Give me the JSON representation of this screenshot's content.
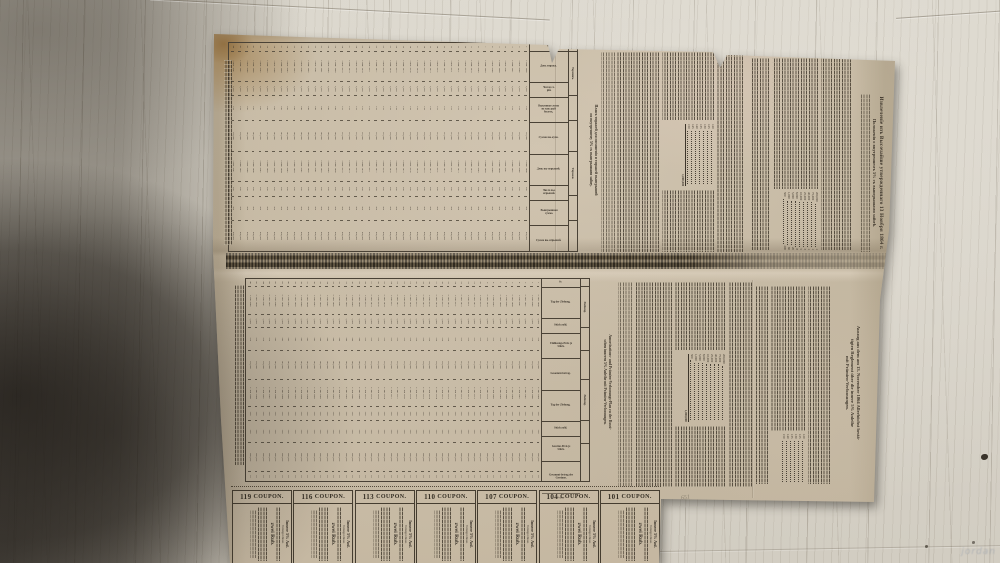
{
  "photo": {
    "watermark": "jordan",
    "pencil_note": "651"
  },
  "russian_section": {
    "heading_line1": "Извлеченіе изъ Высочайше утвержденнаго 13 Ноября 1864 г.",
    "heading_line2": "Положенія о внутреннемъ 5% съ выигрышами займѣ.",
    "table_title_line1": "Планъ тиражей для погашенія и тиражей выигрышей",
    "table_title_line2": "по внутреннему 5% съ выигрышами займу.",
    "prize_total": "1,000,000",
    "prize_amounts": [
      "200,000",
      "75,000",
      "40,000",
      "25,000",
      "10,000",
      "8,000",
      "5,000",
      "1,000",
      "500"
    ],
    "prize_counts": [
      "1",
      "1",
      "1",
      "3",
      "5",
      "8",
      "20",
      "60",
      "200"
    ],
    "redemption_ladder": [
      "120",
      "125",
      "130",
      "135",
      "140",
      "145",
      "150"
    ],
    "table": {
      "group1_label": "Терминъ.",
      "group2_label": "Тиражи.",
      "col_headers": [
        "№",
        "День тиража.",
        "Число се-рій.",
        "Выкупная сумма на каж-дый билетъ.",
        "Сумма вы-купа.",
        "День вы-игрышей.",
        "Число вы-игрышей.",
        "Выигрышная сумма.",
        "Сумма вы-игрышей."
      ],
      "row_count": 44,
      "row_start": 1,
      "dates": [
        "2 Янв.",
        "1 Іюл."
      ],
      "year_start": 1866,
      "series_count": "1,000",
      "prices": [
        "120",
        "125",
        "130",
        "135",
        "140",
        "145",
        "150"
      ],
      "sums": [
        "120,000",
        "125,000",
        "130,000",
        "135,000",
        "140,000",
        "145,000",
        "150,000"
      ],
      "win_count": "300",
      "win_price": "500",
      "win_sum": "600,000"
    }
  },
  "german_section": {
    "heading_line1": "Auszug aus dem am 13. November 1864 Allerhöchst bestä-",
    "heading_line2": "tigten Reglement über die innere 5% Anleihe",
    "heading_line3": "mit Prämien-Verloosungen.",
    "table_title_line1": "Amortisations- und Prämien-Verloosungs-Plan zu der Russi-",
    "table_title_line2": "schen inneren 5% Anleihe mit Prämien-Verloosungen.",
    "prize_total": "1,000,000",
    "prize_amounts": [
      "200,000",
      "75,000",
      "40,000",
      "25,000",
      "10,000",
      "8,000",
      "5,000",
      "1,000",
      "500"
    ],
    "price_ladder": [
      "120",
      "125",
      "130",
      "135",
      "140",
      "150"
    ],
    "ladder_note": "R. per Stück",
    "table": {
      "group1_label": "Ziehung.",
      "group2_label": "Ziehung.",
      "col_headers": [
        "№",
        "Tag der Ziehung.",
        "Stück-zahl.",
        "Einlösungs-Preis je Stück.",
        "Gesammt-betrag.",
        "Tag der Ziehung.",
        "Stück-zahl.",
        "Gewinn-Preis je Stück.",
        "Gesammt-betrag der Gewinne.",
        "Präm."
      ],
      "row_count": 46,
      "row_start": 1,
      "dates": [
        "2. Jan.",
        "1. Juli"
      ],
      "year_start": 1866,
      "series_count": "1,000",
      "prices": [
        "120",
        "125",
        "130",
        "135",
        "140",
        "145",
        "150"
      ],
      "sums": [
        "120,000",
        "125,000",
        "130,000",
        "135,000",
        "140,000",
        "145,000",
        "150,000"
      ],
      "win_count": "300",
      "win_price": "500",
      "win_sum": "600,000",
      "praemie": "10"
    }
  },
  "coupons": {
    "label": "COUPON.",
    "numbers": [
      "119",
      "116",
      "113",
      "110",
      "107",
      "104",
      "101"
    ],
    "body_line1": "Innere 5% Anl.",
    "body_line2": "Vorzeiger dieses",
    "body_line3": "zwei Rub."
  }
}
